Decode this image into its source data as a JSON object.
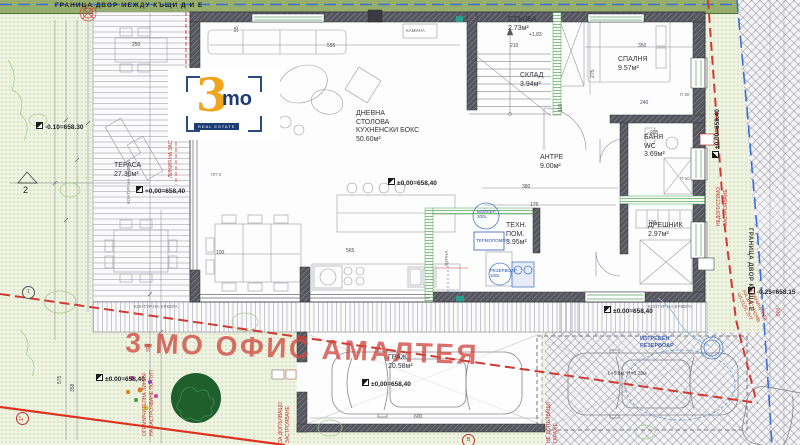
{
  "logo": {
    "digit": "3",
    "suffix": "mo",
    "tagline": "REAL ESTATE"
  },
  "labels": [
    {
      "n": "boundary-top",
      "t": "ГРАНИЦА ДВОР МЕЖДУ КЪЩИ Д И Е",
      "x": 55,
      "y": 2,
      "c": "bnd"
    },
    {
      "n": "boundary-right",
      "t": "ГРАНИЦА ДВОР КЪЩА Е",
      "x": 753,
      "y": 228,
      "r": 90,
      "c": "bnd2"
    },
    {
      "n": "watermark",
      "t": "3-МО ОФИС АМАЛТЕЯ",
      "x": 126,
      "y": 326,
      "r": 2,
      "c": "wm"
    },
    {
      "n": "room-terasa",
      "t": "ТЕРАСА\n27.30м²",
      "x": 114,
      "y": 162,
      "c": "room"
    },
    {
      "n": "room-dnevna-stolova",
      "t": "ДНЕВНА\nСТОЛОВА\nКУХНЕНСКИ БОКС\n50.60м²",
      "x": 356,
      "y": 110,
      "c": "room"
    },
    {
      "n": "room-stalba",
      "t": "СТЪЛБА\n2.73м²",
      "x": 508,
      "y": 16,
      "c": "room"
    },
    {
      "n": "room-sklad",
      "t": "СКЛАД\n3.94м²",
      "x": 520,
      "y": 72,
      "c": "room"
    },
    {
      "n": "room-spalnya",
      "t": "СПАЛНЯ\n9.57м²",
      "x": 618,
      "y": 56,
      "c": "room"
    },
    {
      "n": "room-antre",
      "t": "АНТРЕ\n9.00м²",
      "x": 540,
      "y": 154,
      "c": "room"
    },
    {
      "n": "room-banya",
      "t": "БАНЯ\nWC\n3.69м²",
      "x": 644,
      "y": 134,
      "c": "room"
    },
    {
      "n": "room-dreshnik",
      "t": "ДРЕШНИК\n2.97м²",
      "x": 648,
      "y": 222,
      "c": "room"
    },
    {
      "n": "room-tehn-pom",
      "t": "ТЕХН.\nПОМ.\n3.95м²",
      "x": 506,
      "y": 222,
      "c": "room"
    },
    {
      "n": "room-garaj",
      "t": "ГРАЖ\n20.58м²",
      "x": 388,
      "y": 354,
      "c": "room"
    },
    {
      "n": "level-yard-left",
      "t": "-0.10=658.30",
      "x": 36,
      "y": 122,
      "c": "lvl"
    },
    {
      "n": "level-terrace",
      "t": "+0,00=658,40",
      "x": 136,
      "y": 186,
      "c": "lvl"
    },
    {
      "n": "level-living",
      "t": "±0,00=658,40",
      "x": 388,
      "y": 178,
      "c": "lvl lg"
    },
    {
      "n": "level-south",
      "t": "±0.00=658,40",
      "x": 604,
      "y": 306,
      "c": "lvl lg"
    },
    {
      "n": "level-garage",
      "t": "±0,00=658,40",
      "x": 362,
      "y": 379,
      "c": "lvl"
    },
    {
      "n": "level-yard-bottom",
      "t": "±0.00=658,40",
      "x": 96,
      "y": 374,
      "c": "lvl"
    },
    {
      "n": "level-right",
      "t": "±0.00=658.40",
      "x": 712,
      "y": 158,
      "r": -90,
      "c": "lvl"
    },
    {
      "n": "level-parking",
      "t": "-0.25=658.15",
      "x": 748,
      "y": 287,
      "c": "lvl"
    },
    {
      "n": "note-stalba-level",
      "t": "+1,83",
      "x": 529,
      "y": 32,
      "c": "dim"
    },
    {
      "n": "note-linia-zastroyavane",
      "t": "ЛИНИЯ НА ЗАСТРОЯВАНЕ",
      "x": 168,
      "y": 178,
      "r": -90,
      "c": "red sm"
    },
    {
      "n": "note-ogranichitelna-linia",
      "t": "ОГРАНИЧИТЕЛНА ЛИНИЯ\nНА ЗАСТРОЯВАНЕ ПО ПУП",
      "x": 142,
      "y": 436,
      "r": -90,
      "c": "red sm"
    },
    {
      "n": "note-za-dopalvashto",
      "t": "ЗА ДОПЪЛВАЩО\nЗАСТРОЯВАНЕ",
      "x": 278,
      "y": 443,
      "r": -90,
      "c": "red sm"
    },
    {
      "n": "note-ne-dopalvashto",
      "t": "НЕ ДОПЪЛВАЩО\nГАРАЖЕ",
      "x": 546,
      "y": 443,
      "r": -90,
      "c": "red sm"
    },
    {
      "n": "note-nedopustimo",
      "t": "НЕДОПУСТИМО\nЗАСТРОЯВАНЕ",
      "x": 716,
      "y": 226,
      "r": -90,
      "c": "red sm"
    },
    {
      "n": "note-ogranichitel-zut",
      "t": "ОГРАНИЧИТЕЛ.\nНА ЗАСТРОЯВ.\nЧЛ.21(5) ЗУТ",
      "x": 752,
      "y": 286,
      "r": 64,
      "c": "red sm"
    },
    {
      "n": "dim-300-red",
      "t": "300",
      "x": 146,
      "y": 352,
      "r": -90,
      "c": "red sm"
    },
    {
      "n": "dim-500-red",
      "t": "500",
      "x": 776,
      "y": 316,
      "r": -90,
      "c": "red sm"
    },
    {
      "n": "equip-boiler",
      "t": "БОЙЛЕР\n300L",
      "x": 477,
      "y": 209,
      "c": "blue eq"
    },
    {
      "n": "equip-termopompa",
      "t": "ТЕРМОПОМПА",
      "x": 476,
      "y": 238,
      "c": "blue eq"
    },
    {
      "n": "equip-rezervoar",
      "t": "РЕЗЕРВОАР\n100L",
      "x": 490,
      "y": 268,
      "c": "blue eq"
    },
    {
      "n": "note-izgreben-rezervoar",
      "t": "ИЗГРЕБЕН\nРЕЗЕРВОАР",
      "x": 640,
      "y": 336,
      "c": "blue eq2"
    },
    {
      "n": "note-rezervoar-dims",
      "t": "L=5.8м  H=0.25м",
      "x": 608,
      "y": 371,
      "c": "dim"
    },
    {
      "n": "note-kontur-erkera-1",
      "t": "КОНТУР НА ЕРКЕРА",
      "x": 134,
      "y": 304,
      "c": "tiny"
    },
    {
      "n": "note-kontur-erkera-2",
      "t": "КОНТУР НА ЕРКЕРА",
      "x": 648,
      "y": 304,
      "c": "tiny"
    },
    {
      "n": "note-kontur-erkera-3",
      "t": "КОНТУР НА ЕРКЕРА",
      "x": 126,
      "y": 204,
      "r": -90,
      "c": "tiny"
    },
    {
      "n": "note-kamina",
      "t": "КАМИНА",
      "x": 406,
      "y": 28,
      "c": "tiny"
    },
    {
      "n": "note-furna",
      "t": "ФУРНА",
      "x": 444,
      "y": 266,
      "r": -90,
      "c": "tiny"
    },
    {
      "n": "note-pp0",
      "t": "ПП 0",
      "x": 211,
      "y": 172,
      "c": "tiny"
    },
    {
      "n": "note-p60-a",
      "t": "П 60",
      "x": 680,
      "y": 92,
      "c": "tiny"
    },
    {
      "n": "note-p60-b",
      "t": "П 60",
      "x": 680,
      "y": 176,
      "c": "tiny"
    },
    {
      "n": "marker-2",
      "t": "2",
      "x": 23,
      "y": 185,
      "c": "mark"
    },
    {
      "n": "marker-1-upper",
      "t": "1",
      "x": 22,
      "y": 286,
      "c": "circ dk"
    },
    {
      "n": "marker-1-lower",
      "t": "1*",
      "x": 16,
      "y": 425,
      "r": -90,
      "c": "circ"
    },
    {
      "n": "marker-v",
      "t": "В",
      "x": 462,
      "y": 434,
      "c": "circ"
    },
    {
      "n": "dim-250",
      "t": "250",
      "x": 132,
      "y": 42,
      "c": "dim"
    },
    {
      "n": "dim-595",
      "t": "595",
      "x": 327,
      "y": 43,
      "c": "dim"
    },
    {
      "n": "dim-210",
      "t": "210",
      "x": 510,
      "y": 43,
      "c": "dim"
    },
    {
      "n": "dim-350",
      "t": "350",
      "x": 638,
      "y": 43,
      "c": "dim"
    },
    {
      "n": "dim-55",
      "t": "55",
      "x": 234,
      "y": 32,
      "r": -90,
      "c": "dim"
    },
    {
      "n": "dim-275",
      "t": "275",
      "x": 590,
      "y": 78,
      "r": -90,
      "c": "dim"
    },
    {
      "n": "dim-240",
      "t": "240",
      "x": 640,
      "y": 100,
      "c": "dim"
    },
    {
      "n": "dim-205",
      "t": "205",
      "x": 650,
      "y": 130,
      "c": "dim"
    },
    {
      "n": "dim-110-a",
      "t": "110",
      "x": 558,
      "y": 112,
      "r": -90,
      "c": "dim"
    },
    {
      "n": "dim-380",
      "t": "380",
      "x": 522,
      "y": 184,
      "c": "dim"
    },
    {
      "n": "dim-175",
      "t": "175",
      "x": 530,
      "y": 202,
      "c": "dim"
    },
    {
      "n": "dim-120",
      "t": "120",
      "x": 648,
      "y": 220,
      "c": "dim"
    },
    {
      "n": "dim-110-b",
      "t": "110",
      "x": 576,
      "y": 294,
      "c": "dim"
    },
    {
      "n": "dim-100",
      "t": "100",
      "x": 216,
      "y": 250,
      "c": "dim"
    },
    {
      "n": "dim-565",
      "t": "565",
      "x": 346,
      "y": 248,
      "c": "dim"
    },
    {
      "n": "dim-600",
      "t": "600",
      "x": 414,
      "y": 414,
      "c": "dim"
    },
    {
      "n": "dim-575",
      "t": "575",
      "x": 57,
      "y": 384,
      "r": -90,
      "c": "dim"
    },
    {
      "n": "dim-358",
      "t": "358",
      "x": 70,
      "y": 392,
      "r": -90,
      "c": "dim"
    }
  ]
}
